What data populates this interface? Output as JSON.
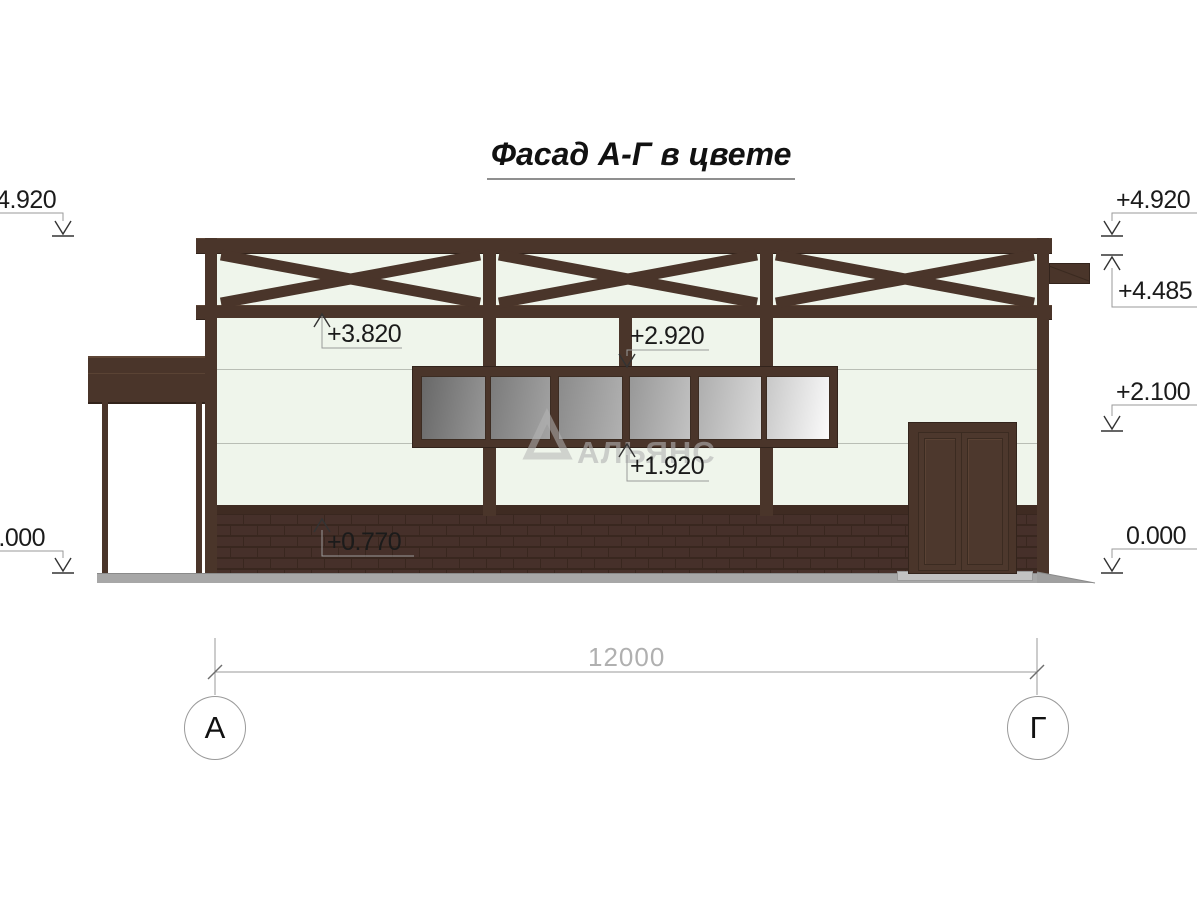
{
  "title": "Фасад А-Г в цвете",
  "watermark": {
    "text": "АЛЬЯНС"
  },
  "elevations": {
    "left_4920": "+4.920",
    "left_0000": "0.000",
    "right_4920": "+4.920",
    "right_4485": "+4.485",
    "right_2100": "+2.100",
    "right_0000": "0.000",
    "mark_3820": "+3.820",
    "mark_2920": "+2.920",
    "mark_1920": "+1.920",
    "mark_0770": "+0.770"
  },
  "dimension": {
    "total": "12000"
  },
  "grid": {
    "left_axis": "А",
    "right_axis": "Г"
  },
  "colors": {
    "frame_brown": "#4a352a",
    "wall": "#eff5eb",
    "brick": "#46302a",
    "glass_dark": "#686868",
    "glass_light": "#fbfbfb",
    "ground": "#a7a7a7",
    "annotation_gray": "#9a9a9a"
  }
}
